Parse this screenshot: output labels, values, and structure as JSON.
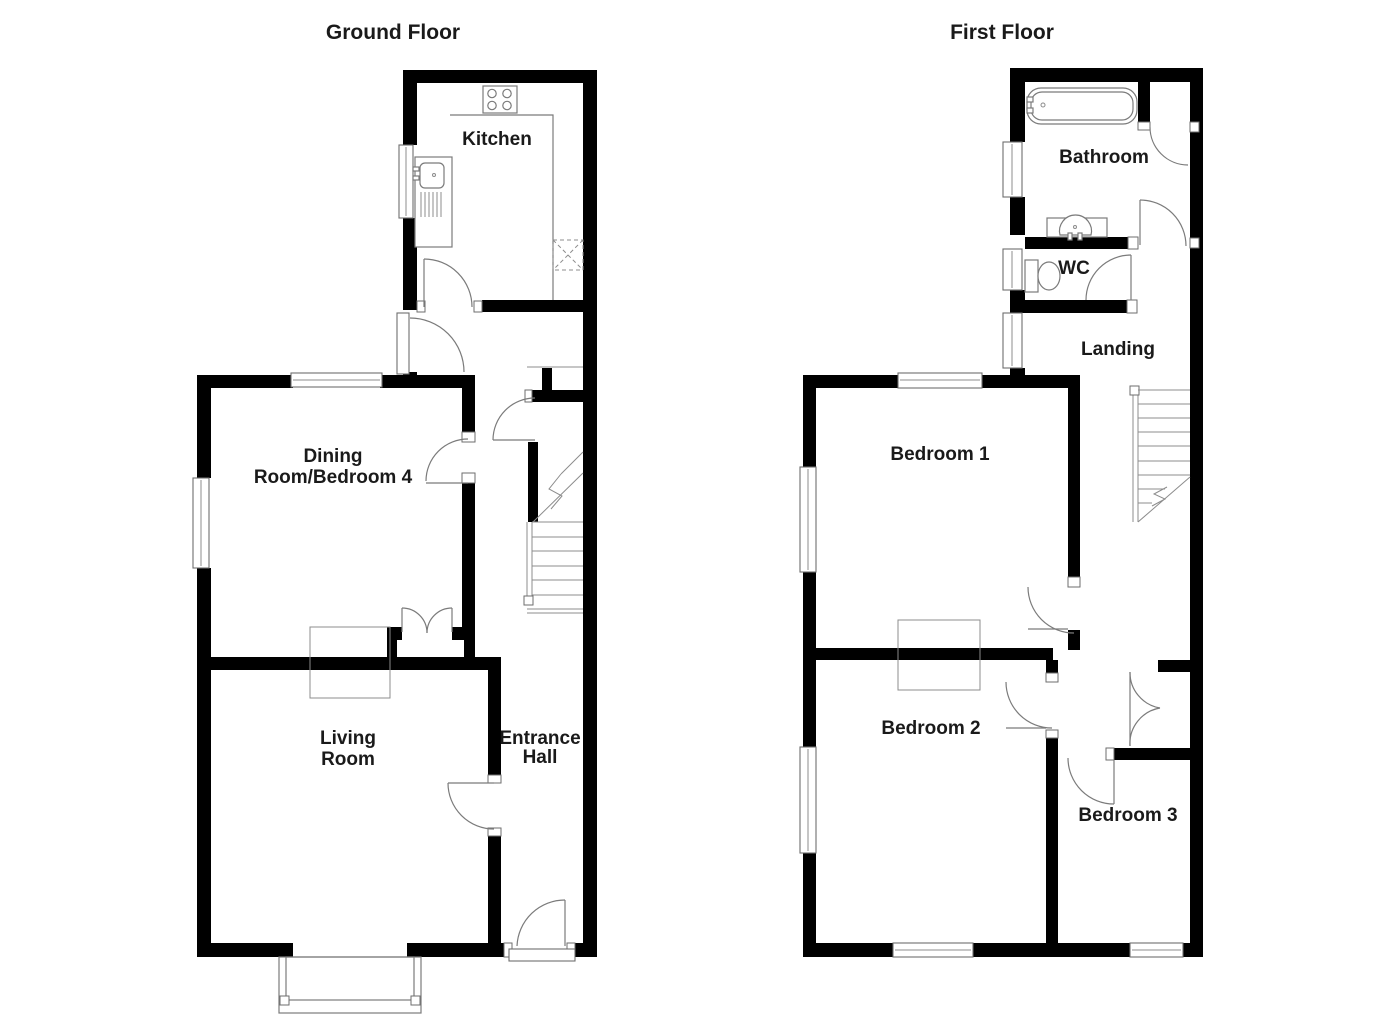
{
  "ground": {
    "title": "Ground Floor",
    "kitchen": "Kitchen",
    "dining_line1": "Dining",
    "dining_line2": "Room/Bedroom 4",
    "living_line1": "Living",
    "living_line2": "Room",
    "hall_line1": "Entrance",
    "hall_line2": "Hall"
  },
  "first": {
    "title": "First Floor",
    "bathroom": "Bathroom",
    "wc": "WC",
    "landing": "Landing",
    "bedroom1": "Bedroom 1",
    "bedroom2": "Bedroom 2",
    "bedroom3": "Bedroom 3"
  },
  "fixtures": {
    "ground": [
      "hob",
      "sink-drainer",
      "appliance-space",
      "stairs-up",
      "bay-window",
      "chimney-breast",
      "front-door"
    ],
    "first": [
      "bath",
      "basin",
      "toilet",
      "stairs-down",
      "cupboard",
      "chimney-breast"
    ]
  },
  "colors": {
    "wall": "#000000",
    "thin_line": "#7b7b7b",
    "text": "#1a1a1a",
    "background": "#ffffff"
  }
}
